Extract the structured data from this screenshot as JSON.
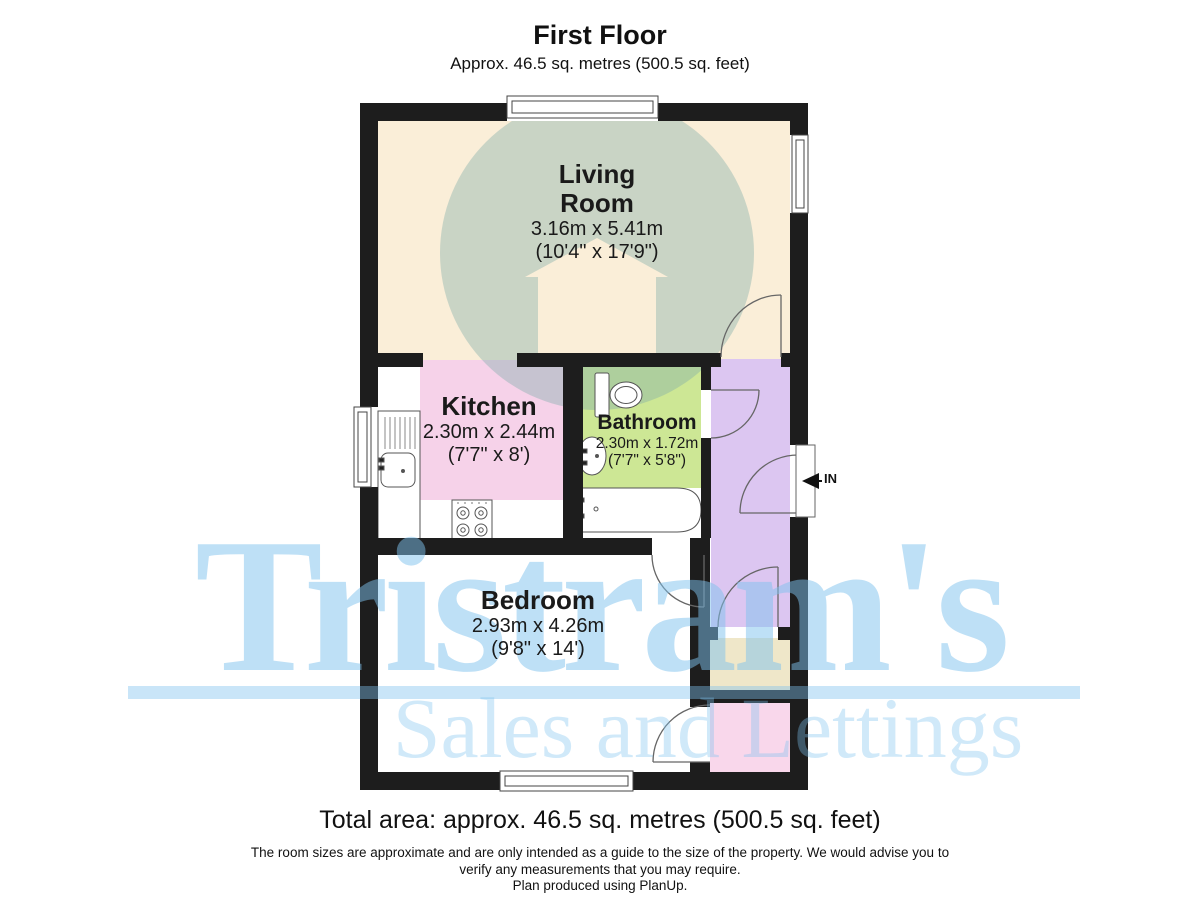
{
  "header": {
    "title": "First Floor",
    "subtitle": "Approx. 46.5 sq. metres (500.5 sq. feet)"
  },
  "rooms": [
    {
      "id": "living-room",
      "name": "Living Room",
      "name_line1": "Living",
      "name_line2": "Room",
      "dim_metric": "3.16m x 5.41m",
      "dim_imperial": "(10'4\" x 17'9\")",
      "fill": "#faeed8"
    },
    {
      "id": "kitchen",
      "name": "Kitchen",
      "dim_metric": "2.30m x 2.44m",
      "dim_imperial": "(7'7\" x 8')",
      "fill": "#f6d2e9"
    },
    {
      "id": "bathroom",
      "name": "Bathroom",
      "dim_metric": "2.30m x 1.72m",
      "dim_imperial": "(7'7\" x 5'8\")",
      "fill": "#cde795"
    },
    {
      "id": "bedroom",
      "name": "Bedroom",
      "dim_metric": "2.93m x 4.26m",
      "dim_imperial": "(9'8\" x 14')",
      "fill": "#ffffff"
    }
  ],
  "other_areas": [
    {
      "id": "hallway",
      "fill": "#dcc6f1"
    },
    {
      "id": "store-cupboard-top",
      "fill": "#efe7c9"
    },
    {
      "id": "store-cupboard-bottom",
      "fill": "#f9d7eb"
    }
  ],
  "entrance": {
    "label": "IN"
  },
  "watermark": {
    "name": "Tristram's",
    "tagline": "Sales and Lettings",
    "color": "#7ec1ee"
  },
  "footer": {
    "total_area": "Total area: approx. 46.5 sq. metres (500.5 sq. feet)",
    "disclaimer_line1": "The room sizes are approximate and are only intended as a guide to the size of the property. We would advise you to",
    "disclaimer_line2": "verify any measurements that you may require.",
    "produced_by": "Plan produced using PlanUp."
  },
  "colors": {
    "wall": "#1d1d1d",
    "living_room": "#faeed8",
    "kitchen": "#f6d2e9",
    "bathroom": "#cde795",
    "hallway": "#dcc6f1",
    "store": "#efe7c9",
    "cupboard": "#f9d7eb",
    "logo_circle": "#80acaa",
    "watermark_blue": "#7ec1ee"
  }
}
